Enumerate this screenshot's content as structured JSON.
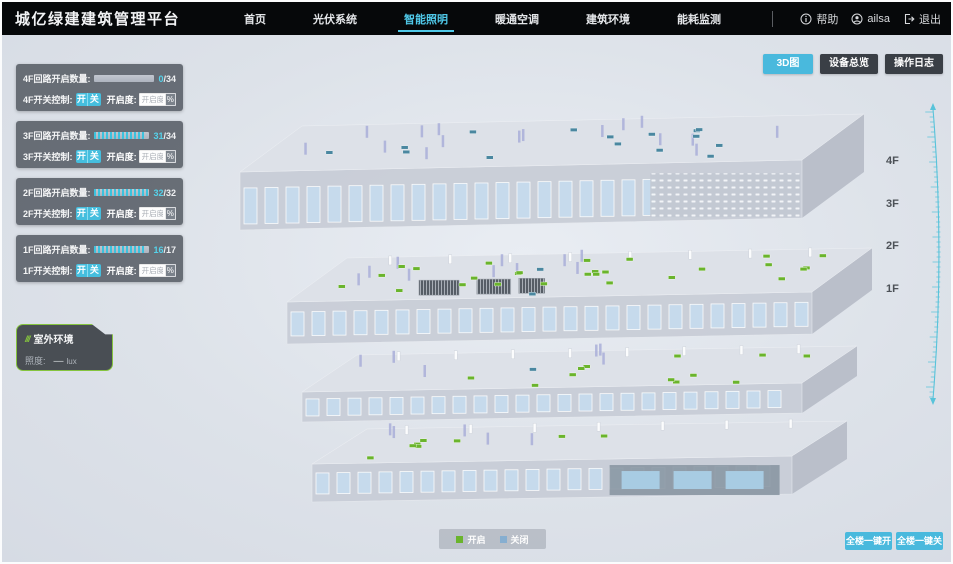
{
  "header": {
    "title": "城亿绿建建筑管理平台",
    "nav": [
      {
        "label": "首页",
        "active": false
      },
      {
        "label": "光伏系统",
        "active": false
      },
      {
        "label": "智能照明",
        "active": true
      },
      {
        "label": "暖通空调",
        "active": false
      },
      {
        "label": "建筑环境",
        "active": false
      },
      {
        "label": "能耗监测",
        "active": false
      }
    ],
    "help_label": "帮助",
    "user_name": "ailsa",
    "logout_label": "退出"
  },
  "floor_panels": [
    {
      "floor": "4F",
      "circuit_label": "4F回路开启数量:",
      "on": 0,
      "total": 34,
      "num": "0",
      "den": "/34",
      "switch_label": "4F开关控制:",
      "on_btn": "开",
      "off_btn": "关",
      "dim_label": "开启度:",
      "dim_placeholder": "开启度",
      "percent": "%"
    },
    {
      "floor": "3F",
      "circuit_label": "3F回路开启数量:",
      "on": 31,
      "total": 34,
      "num": "31",
      "den": "/34",
      "switch_label": "3F开关控制:",
      "on_btn": "开",
      "off_btn": "关",
      "dim_label": "开启度:",
      "dim_placeholder": "开启度",
      "percent": "%"
    },
    {
      "floor": "2F",
      "circuit_label": "2F回路开启数量:",
      "on": 32,
      "total": 32,
      "num": "32",
      "den": "/32",
      "switch_label": "2F开关控制:",
      "on_btn": "开",
      "off_btn": "关",
      "dim_label": "开启度:",
      "dim_placeholder": "开启度",
      "percent": "%"
    },
    {
      "floor": "1F",
      "circuit_label": "1F回路开启数量:",
      "on": 16,
      "total": 17,
      "num": "16",
      "den": "/17",
      "switch_label": "1F开关控制:",
      "on_btn": "开",
      "off_btn": "关",
      "dim_label": "开启度:",
      "dim_placeholder": "开启度",
      "percent": "%"
    }
  ],
  "outdoor": {
    "icon": "///",
    "title": "室外环境",
    "illuminance_label": "照度:",
    "value": "—",
    "unit": "lux"
  },
  "view_buttons": [
    {
      "label": "3D图",
      "active": true
    },
    {
      "label": "设备总览",
      "active": false
    },
    {
      "label": "操作日志",
      "active": false
    }
  ],
  "floor_labels": [
    "4F",
    "3F",
    "2F",
    "1F"
  ],
  "legend": {
    "on": "开启",
    "off": "关闭"
  },
  "bulk_buttons": [
    "全楼一键开",
    "全楼一键关"
  ],
  "colors": {
    "accent_cyan": "#49b9dd",
    "active_nav": "#4fc8e8",
    "light_on_green": "#6ab42c",
    "light_off_blue": "#4a87a0",
    "legend_off_blue": "#86aed0",
    "outdoor_border_green": "#85c43e"
  },
  "scene": {
    "floors": [
      {
        "name": "4F",
        "lights_on": 0,
        "lights_off": 15
      },
      {
        "name": "3F",
        "lights_on": 27,
        "lights_off": 2
      },
      {
        "name": "2F",
        "lights_on": 12,
        "lights_off": 1
      },
      {
        "name": "1F",
        "lights_on": 8,
        "lights_off": 0
      }
    ]
  }
}
